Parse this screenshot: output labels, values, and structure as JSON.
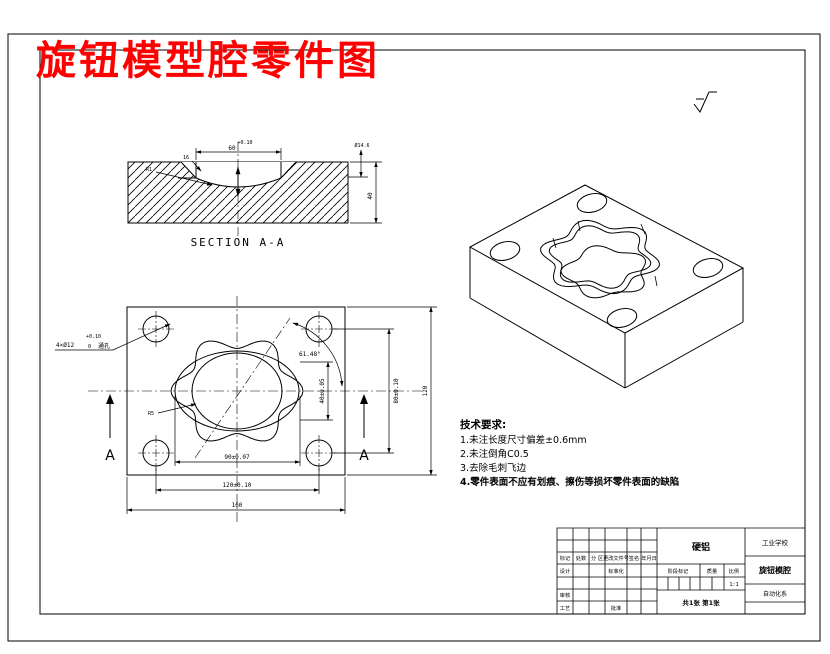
{
  "title": "旋钮模型腔零件图",
  "colors": {
    "background": "#ffffff",
    "line": "#000000",
    "title_red": "#ff0000"
  },
  "section_view": {
    "caption": "SECTION A-A",
    "dims": {
      "width_tol": "+0.10",
      "width": "60",
      "chamfer": "16",
      "radius": "R1",
      "step": "Ø14.6",
      "height": "40"
    }
  },
  "front_view": {
    "section_label_left": "A",
    "section_label_right": "A",
    "leader": {
      "tol_top": "+0.10",
      "text": "4×Ø12",
      "tol_bottom": "0",
      "note": "通孔"
    },
    "angle": "61.48°",
    "radius": "R5",
    "dims": {
      "width_inner": "90±0.07",
      "width_mid": "120±0.10",
      "width_outer": "160",
      "height_inner": "40±0.05",
      "height_mid": "80±0.10",
      "height_outer": "120"
    }
  },
  "tech_requirements": {
    "heading": "技术要求:",
    "items": [
      "1.未注长度尺寸偏差±0.6mm",
      "2.未注倒角C0.5",
      "3.去除毛刺飞边",
      "4.零件表面不应有划痕、擦伤等损坏零件表面的缺陷"
    ]
  },
  "title_block": {
    "material": "硬铝",
    "school": "工业学校",
    "part_name": "旋钮模腔",
    "department": "自动化系",
    "header": [
      "标记",
      "处数",
      "分 区",
      "更改文件号",
      "签名",
      "年月日"
    ],
    "row_design": "设计",
    "row_standard": "标准化",
    "row_check": "审核",
    "row_process": "工艺",
    "row_approve": "批准",
    "stage_label": "阶段标记",
    "weight_label": "质量",
    "scale_label": "比例",
    "scale_value": "1:1",
    "sheet_info": "共1张 第1张"
  }
}
